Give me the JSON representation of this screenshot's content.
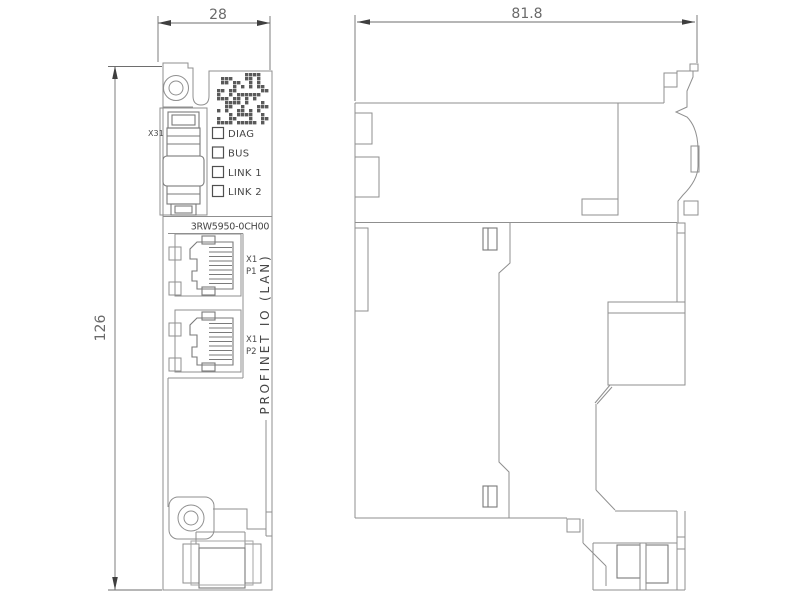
{
  "dimensions": {
    "front_width": "28",
    "front_height": "126",
    "side_depth": "81.8"
  },
  "front_view": {
    "connector_label": "X31",
    "leds": [
      {
        "label": "DIAG"
      },
      {
        "label": "BUS"
      },
      {
        "label": "LINK 1"
      },
      {
        "label": "LINK 2"
      }
    ],
    "product_code": "3RW5950-0CH00",
    "ports": [
      {
        "id": "X1",
        "port": "P1"
      },
      {
        "id": "X1",
        "port": "P2"
      }
    ],
    "interface_label": "PROFINET IO (LAN)"
  },
  "colors": {
    "line": "#8f8f8f",
    "dark_line": "#7a7a7a",
    "dimension": "#6e6e6e",
    "text": "#454545",
    "arrow": "#3f3f3f",
    "background": "#ffffff"
  }
}
